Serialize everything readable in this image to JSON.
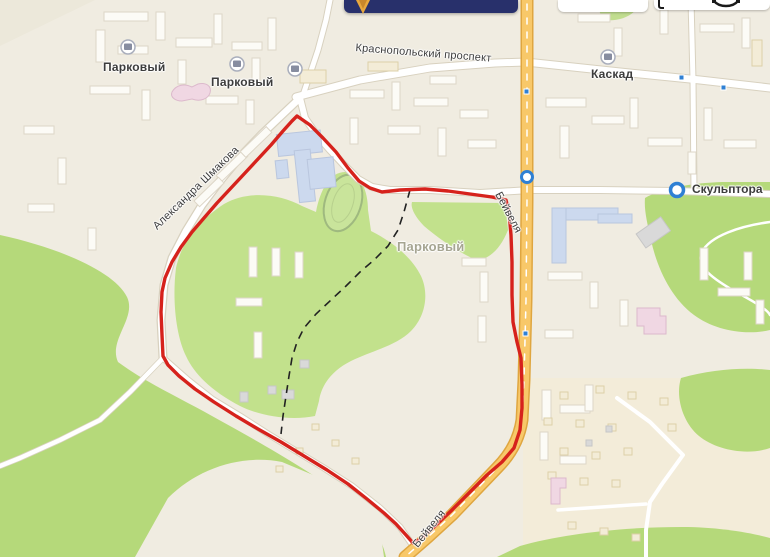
{
  "theme": {
    "bg": "#f0ece1",
    "cream": "#f3ecd7",
    "green": "#b5d97a",
    "greenLight": "#c2e18c",
    "roadYellow": "#f8c869",
    "roadYellowEdge": "#dfa640",
    "roadCasing": "#d8d1bf",
    "red": "#d6221c",
    "navy": "#28306b",
    "arrowGold": "#e8a83e",
    "stopBlue": "#2f80d4",
    "bldBlue": "#ccd9ee",
    "bldPink": "#f0d7e3",
    "labelDark": "#3c3c3c",
    "labelMuted": "#a6a592"
  },
  "app": {
    "top_bar": {
      "logo_icon": "navigator-arrow-icon"
    },
    "toolbar": {
      "buttons": [
        "pedestrian-mode-icon",
        "car-mode-icon"
      ]
    }
  },
  "map": {
    "districts": [
      {
        "id": "parkovyy-nw",
        "label": "Парковый"
      },
      {
        "id": "parkovyy-n",
        "label": "Парковый"
      },
      {
        "id": "parkovyy-center",
        "label": "Парковый"
      },
      {
        "id": "kaskad",
        "label": "Каскад"
      }
    ],
    "streets": [
      {
        "id": "krasnopolskiy-prospekt",
        "label": "Краснопольский проспект"
      },
      {
        "id": "aleksandra-shmakova",
        "label": "Александра Шмакова"
      },
      {
        "id": "beyvelya-mid",
        "label": "Бейвеля"
      },
      {
        "id": "beyvelya-south",
        "label": "Бейвеля"
      }
    ],
    "stops": [
      {
        "id": "skulptora",
        "label": "Скульптора"
      }
    ],
    "overlay": {
      "selection_outline_color": "#d6221c",
      "route_dash_color": "#222222"
    }
  }
}
